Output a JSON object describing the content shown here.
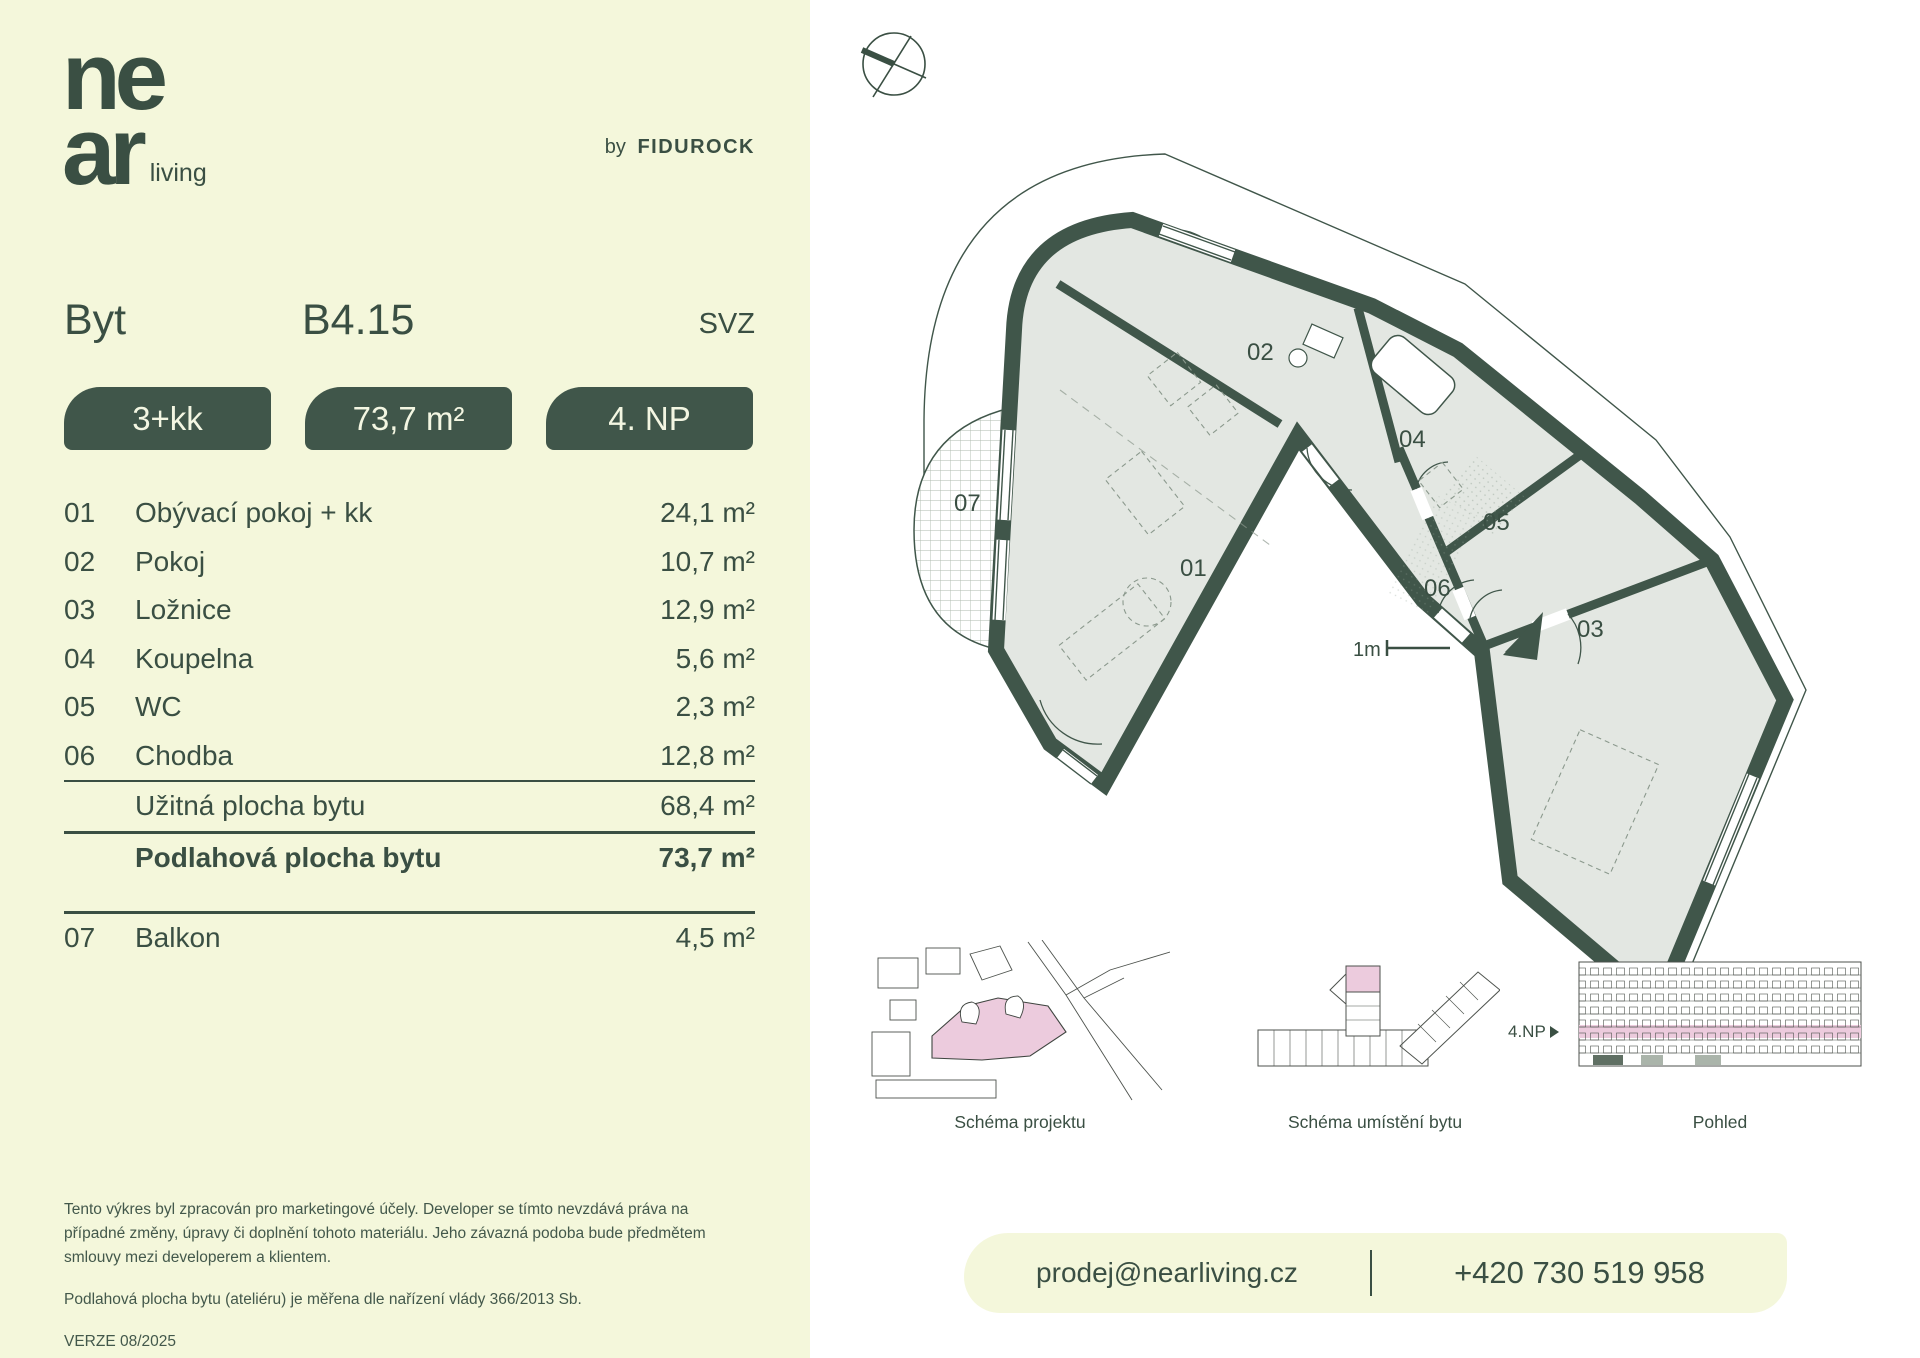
{
  "brand": {
    "logo_line1": "ne",
    "logo_line2": "ar",
    "logo_suffix": "living",
    "byline_prefix": "by",
    "byline_name": "FIDUROCK"
  },
  "header": {
    "label": "Byt",
    "unit": "B4.15",
    "orientation": "SVZ"
  },
  "badges": {
    "layout": "3+kk",
    "area": "73,7 m²",
    "floor": "4. NP"
  },
  "rooms": [
    {
      "num": "01",
      "name": "Obývací pokoj + kk",
      "area": "24,1 m²"
    },
    {
      "num": "02",
      "name": "Pokoj",
      "area": "10,7 m²"
    },
    {
      "num": "03",
      "name": "Ložnice",
      "area": "12,9 m²"
    },
    {
      "num": "04",
      "name": "Koupelna",
      "area": "5,6 m²"
    },
    {
      "num": "05",
      "name": "WC",
      "area": "2,3 m²"
    },
    {
      "num": "06",
      "name": "Chodba",
      "area": "12,8 m²"
    }
  ],
  "summary": {
    "usable_label": "Užitná plocha bytu",
    "usable_area": "68,4 m²",
    "floor_label": "Podlahová plocha bytu",
    "floor_area": "73,7 m²"
  },
  "balcony": {
    "num": "07",
    "name": "Balkon",
    "area": "4,5 m²"
  },
  "floorplan": {
    "scale_label": "1m",
    "labels": {
      "r01": "01",
      "r02": "02",
      "r03": "03",
      "r04": "04",
      "r05": "05",
      "r06": "06",
      "r07": "07"
    }
  },
  "thumbnails": {
    "project": {
      "caption": "Schéma projektu"
    },
    "location": {
      "caption": "Schéma umístění bytu"
    },
    "view": {
      "caption": "Pohled",
      "floor_label": "4.NP"
    }
  },
  "contact": {
    "email": "prodej@nearliving.cz",
    "phone": "+420 730 519 958"
  },
  "disclaimer": {
    "p1": "Tento výkres byl zpracován pro marketingové účely. Developer se tímto nevzdává práva na případné změny, úpravy či doplnění tohoto materiálu. Jeho závazná podoba bude předmětem smlouvy mezi developerem a klientem.",
    "p2": "Podlahová plocha bytu (ateliéru) je měřena dle nařízení vlády 366/2013 Sb.",
    "version": "VERZE 08/2025"
  },
  "colors": {
    "cream": "#f4f7db",
    "green_text": "#3a4f43",
    "green_wall": "#40564a",
    "room_fill": "#e3e7e2",
    "pink": "#eccbdd"
  }
}
